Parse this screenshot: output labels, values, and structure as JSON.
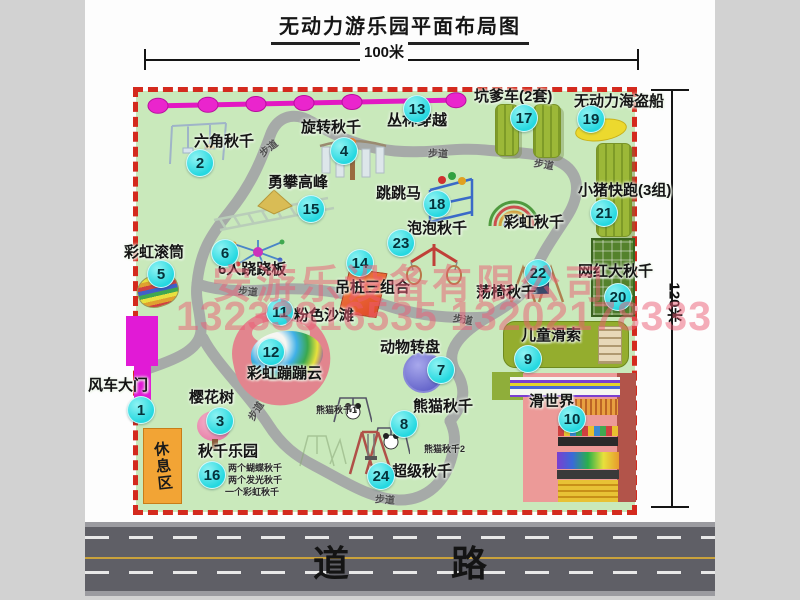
{
  "title": "无动力游乐园平面布局图",
  "dimensions": {
    "width_label": "100米",
    "height_label": "120米"
  },
  "road": {
    "label": "道  路"
  },
  "watermark": {
    "line1": "安游乐设备有限公司",
    "line2": "13233816535 13202178333"
  },
  "rest_area": {
    "label": "休息区"
  },
  "colors": {
    "park_green": "#c9e9bb",
    "border_red": "#d42a1e",
    "marker_cyan": "#25d8e0",
    "zipline_magenta": "#e318c3",
    "olive_equipment": "#9cb838",
    "road_gray": "#5f5f66",
    "watermark_pink": "rgba(235,92,115,0.5)"
  },
  "markers": [
    {
      "n": "1",
      "label": "风车大门",
      "cx": 140,
      "cy": 409,
      "lx": 88,
      "ly": 374
    },
    {
      "n": "2",
      "label": "六角秋千",
      "cx": 199,
      "cy": 162,
      "lx": 194,
      "ly": 130
    },
    {
      "n": "3",
      "label": "樱花树",
      "cx": 219,
      "cy": 420,
      "lx": 189,
      "ly": 386
    },
    {
      "n": "4",
      "label": "旋转秋千",
      "cx": 343,
      "cy": 150,
      "lx": 301,
      "ly": 116
    },
    {
      "n": "5",
      "label": "彩虹滚筒",
      "cx": 160,
      "cy": 273,
      "lx": 124,
      "ly": 241
    },
    {
      "n": "6",
      "label": "6人跷跷板",
      "cx": 224,
      "cy": 252,
      "lx": 218,
      "ly": 258
    },
    {
      "n": "7",
      "label": "动物转盘",
      "cx": 440,
      "cy": 369,
      "lx": 380,
      "ly": 336
    },
    {
      "n": "8",
      "label": "熊猫秋千",
      "cx": 403,
      "cy": 423,
      "lx": 413,
      "ly": 395
    },
    {
      "n": "9",
      "label": "儿童滑索",
      "cx": 527,
      "cy": 358,
      "lx": 521,
      "ly": 324
    },
    {
      "n": "10",
      "label": "滑世界",
      "cx": 571,
      "cy": 418,
      "lx": 529,
      "ly": 390
    },
    {
      "n": "11",
      "label": "粉色沙滩",
      "cx": 279,
      "cy": 311,
      "lx": 294,
      "ly": 304
    },
    {
      "n": "12",
      "label": "彩虹蹦蹦云",
      "cx": 270,
      "cy": 351,
      "lx": 247,
      "ly": 362
    },
    {
      "n": "13",
      "label": "丛林穿越",
      "cx": 416,
      "cy": 108,
      "lx": 387,
      "ly": 109
    },
    {
      "n": "14",
      "label": "吊桩三组合",
      "cx": 359,
      "cy": 262,
      "lx": 335,
      "ly": 276
    },
    {
      "n": "15",
      "label": "勇攀高峰",
      "cx": 310,
      "cy": 208,
      "lx": 268,
      "ly": 171
    },
    {
      "n": "16",
      "label": "秋千乐园",
      "cx": 211,
      "cy": 474,
      "lx": 198,
      "ly": 440
    },
    {
      "n": "17",
      "label": "坑爹车(2套)",
      "cx": 523,
      "cy": 117,
      "lx": 474,
      "ly": 85
    },
    {
      "n": "18",
      "label": "跳跳马",
      "cx": 436,
      "cy": 203,
      "lx": 376,
      "ly": 182
    },
    {
      "n": "19",
      "label": "无动力海盗船",
      "cx": 590,
      "cy": 118,
      "lx": 574,
      "ly": 90
    },
    {
      "n": "20",
      "label": "网红大秋千",
      "cx": 617,
      "cy": 296,
      "lx": 578,
      "ly": 260
    },
    {
      "n": "21",
      "label": "小猪快跑(3组)",
      "cx": 603,
      "cy": 212,
      "lx": 578,
      "ly": 179
    },
    {
      "n": "22",
      "label": "荡椅秋千",
      "cx": 537,
      "cy": 272,
      "lx": 476,
      "ly": 281
    },
    {
      "n": "23",
      "label": "泡泡秋千",
      "cx": 400,
      "cy": 242,
      "lx": 407,
      "ly": 217
    },
    {
      "n": "24",
      "label": "超级秋千",
      "cx": 380,
      "cy": 475,
      "lx": 392,
      "ly": 460
    }
  ],
  "extra_labels": [
    {
      "text": "彩虹秋千",
      "x": 504,
      "y": 211,
      "size": 15
    }
  ],
  "sub_labels": [
    {
      "text": "熊猫秋千1",
      "x": 316,
      "y": 403,
      "size": 9
    },
    {
      "text": "熊猫秋千2",
      "x": 424,
      "y": 442,
      "size": 9
    },
    {
      "text": "两个蝴蝶秋千",
      "x": 228,
      "y": 461,
      "size": 9
    },
    {
      "text": "两个发光秋千",
      "x": 228,
      "y": 473,
      "size": 9
    },
    {
      "text": "一个彩虹秋千",
      "x": 225,
      "y": 485,
      "size": 9
    }
  ],
  "path_label_text": "步道",
  "path_labels": [
    {
      "x": 258,
      "y": 140,
      "r": -38
    },
    {
      "x": 428,
      "y": 145,
      "r": 2
    },
    {
      "x": 534,
      "y": 156,
      "r": 10
    },
    {
      "x": 238,
      "y": 283,
      "r": 4
    },
    {
      "x": 453,
      "y": 311,
      "r": 10
    },
    {
      "x": 245,
      "y": 403,
      "r": -58
    },
    {
      "x": 375,
      "y": 491,
      "r": 4
    }
  ]
}
